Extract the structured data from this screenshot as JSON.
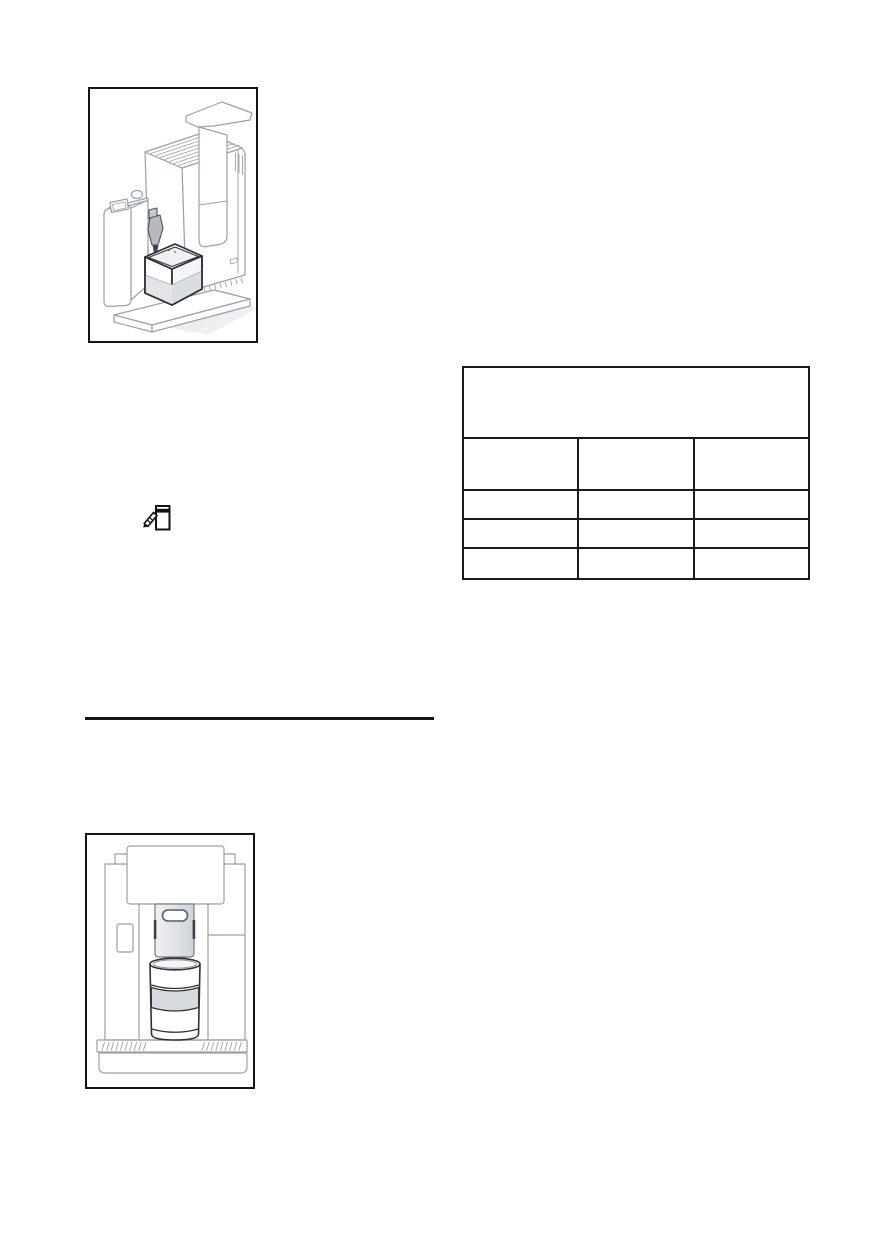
{
  "page": {
    "width": 896,
    "height": 1247,
    "background": "#ffffff"
  },
  "colors": {
    "frame_border": "#141414",
    "table_border": "#1a1a1a",
    "divider": "#141414",
    "line_art_stroke": "#9aa1aa",
    "line_art_dark_stroke": "#2c3036",
    "fill_light_gray": "#e3e5e8",
    "fill_mid_gray": "#d7dade",
    "icon_color": "#111111"
  },
  "icons": {
    "note_icon": "notepad-with-pen"
  },
  "figures": {
    "top": {
      "caption": ""
    },
    "bottom": {
      "caption": ""
    }
  },
  "table": {
    "caption_cell": "",
    "columns": [
      "",
      "",
      ""
    ],
    "rows": [
      [
        "",
        "",
        ""
      ],
      [
        "",
        "",
        ""
      ],
      [
        "",
        "",
        ""
      ]
    ]
  }
}
